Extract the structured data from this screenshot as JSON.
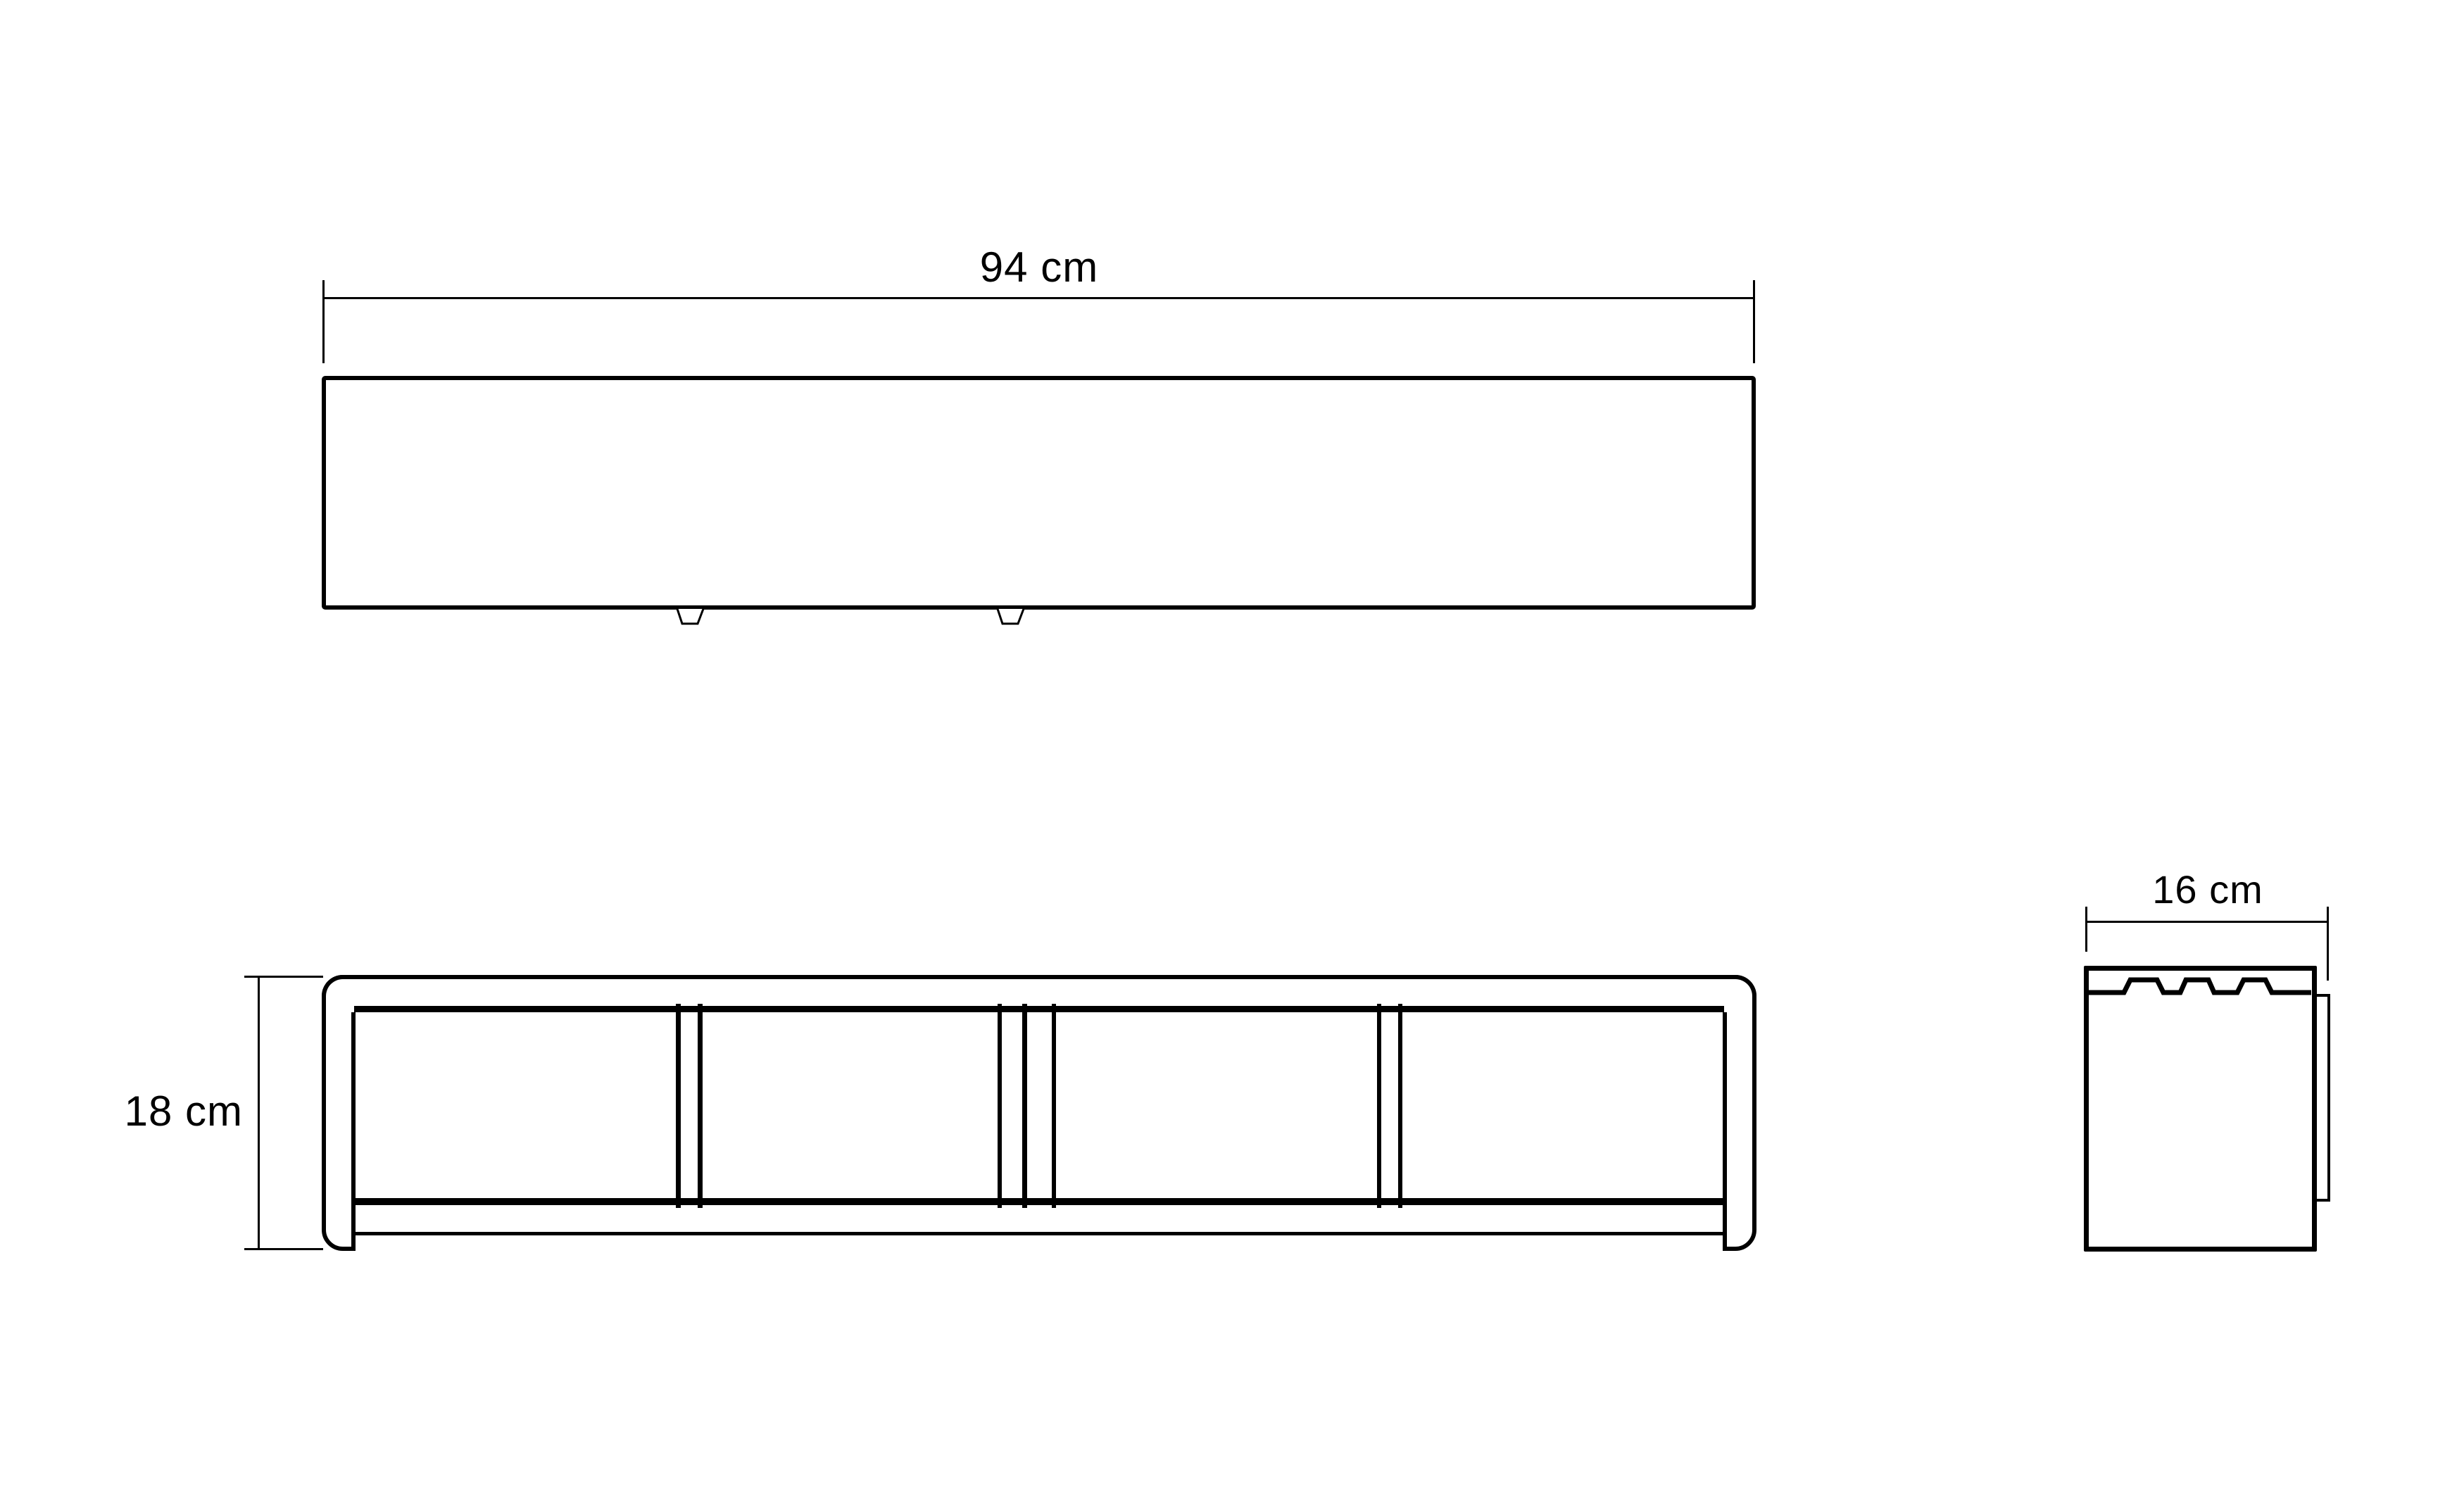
{
  "canvas": {
    "background": "#ffffff",
    "ink": "#000000"
  },
  "views": {
    "top": {
      "dim_label": "94 cm"
    },
    "front": {
      "dim_label": "18 cm"
    },
    "side": {
      "dim_label": "16 cm"
    }
  }
}
